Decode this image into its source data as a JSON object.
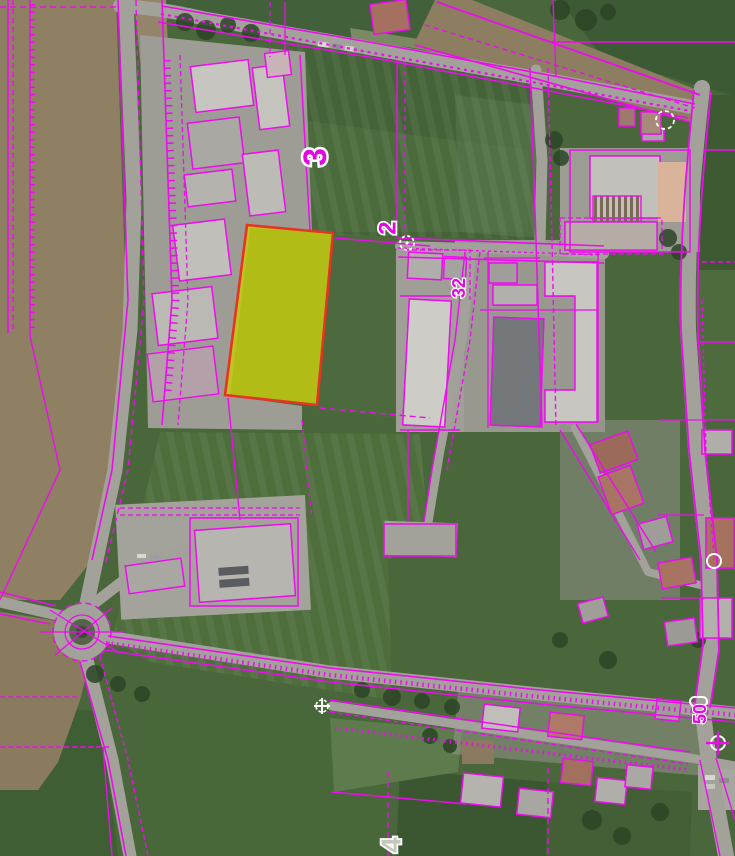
{
  "map": {
    "kind": "cadastral-parcel-overlay-on-aerial-imagery",
    "labels": [
      {
        "id": "parcel-number-3",
        "text": "3"
      },
      {
        "id": "parcel-number-2",
        "text": "2"
      },
      {
        "id": "house-number-32",
        "text": "32"
      },
      {
        "id": "house-number-50",
        "text": "50"
      },
      {
        "id": "parcel-number-4",
        "text": "4"
      }
    ],
    "highlight_parcel": {
      "fill": "#c3cc0f",
      "stroke": "#e93322"
    },
    "colors": {
      "cadastral": "#ed0cee",
      "label": "#e405e4",
      "road": "#a3a29a",
      "field": "#4a673c",
      "farmland": "#8f7f63"
    },
    "symbols": [
      {
        "name": "survey-point-circle-dashed",
        "count": 3
      },
      {
        "name": "survey-point-circle-cross",
        "count": 2
      },
      {
        "name": "culvert-pill",
        "count": 1
      }
    ]
  }
}
